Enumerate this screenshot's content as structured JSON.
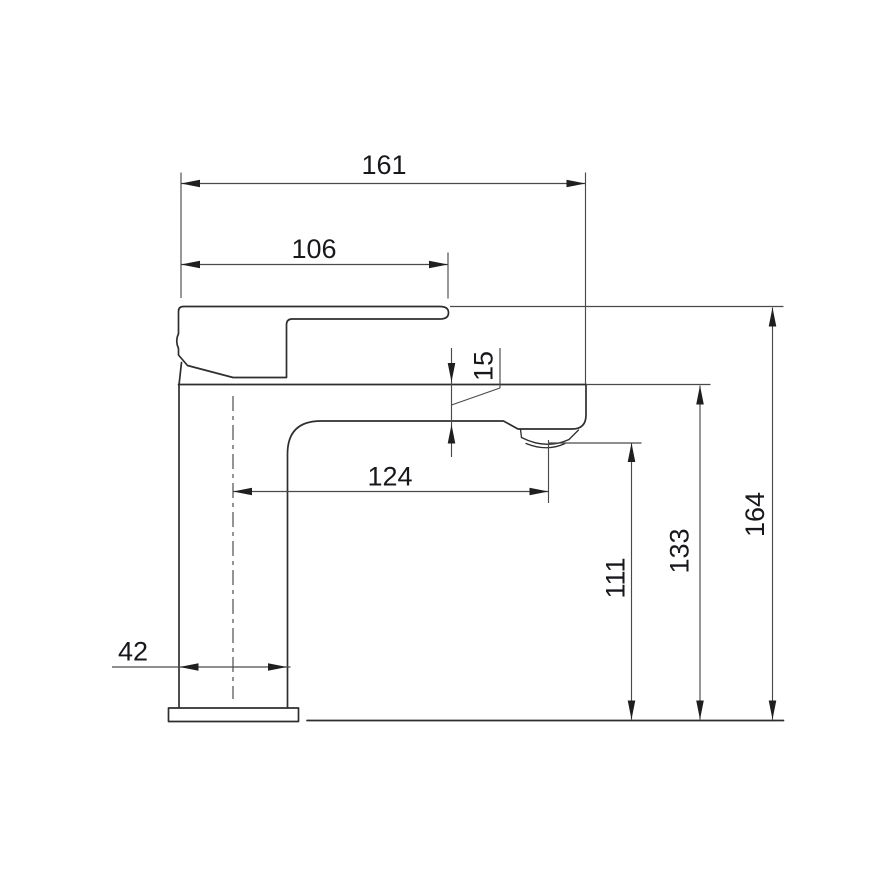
{
  "drawing": {
    "subject": "basin-mixer-faucet-side-elevation",
    "background_color": "#ffffff",
    "object_line_color": "#2e2e2e",
    "dimension_line_color": "#4a4a4a",
    "text_color": "#17171c",
    "dimensions": {
      "overall_projection": "161",
      "handle_projection": "106",
      "spout_thickness": "15",
      "spout_reach": "124",
      "base_width": "42",
      "outlet_height": "111",
      "spout_top_height": "133",
      "overall_height": "164"
    }
  }
}
